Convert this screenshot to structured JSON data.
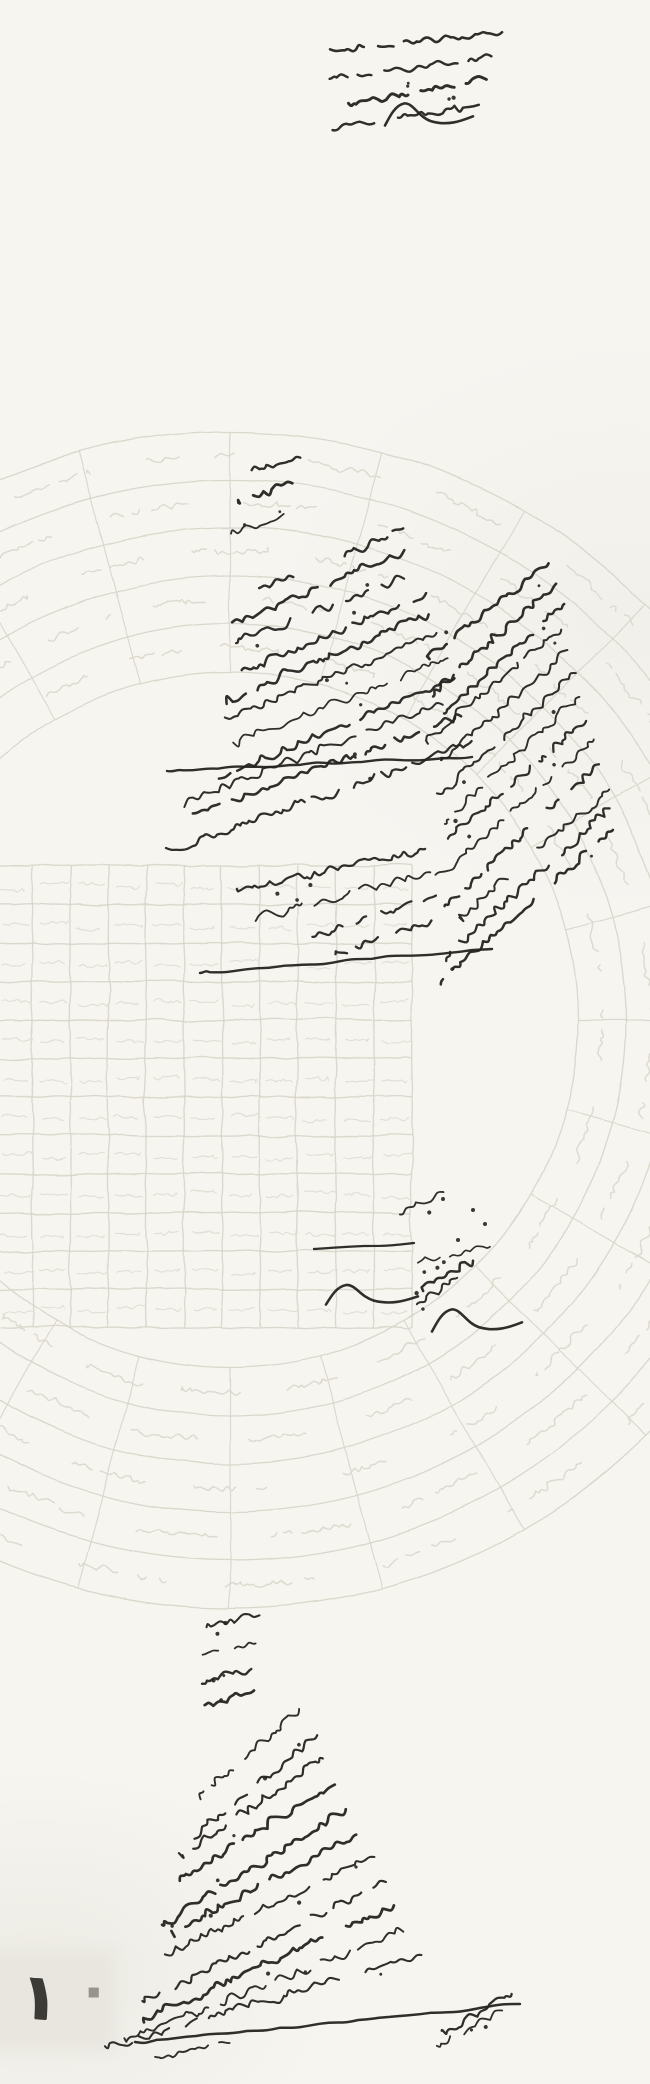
{
  "document": {
    "page_number": "١٠",
    "page_number_chars": [
      "١",
      "٠"
    ]
  },
  "palette": {
    "paper": "#f6f5f0",
    "faint_line": "#d8d4c8",
    "faint_text": "#ddd9cd",
    "grid_line": "#d7d3c7",
    "grid_text": "#e1ded3",
    "ink": "#242320",
    "shade": "#e8e6df",
    "digit_dark": "#3c3b36",
    "digit_light": "#96948d"
  },
  "artwork": {
    "canvas": {
      "width": 650,
      "height": 2084
    },
    "faint_circle": {
      "cx": 230,
      "cy": 1020,
      "ring_radii": [
        588,
        540,
        492,
        444,
        396,
        348
      ],
      "spoke_count": 24,
      "band_text_radii": [
        372,
        420,
        468,
        516,
        564
      ],
      "band_offsets": [
        3,
        9,
        0,
        6,
        11
      ]
    },
    "faint_grid": {
      "x": -6,
      "y": 866,
      "cols": 11,
      "rows": 12,
      "cell_w": 38,
      "cell_h": 38.5
    },
    "ink_blocks": [
      {
        "type": "para",
        "name": "top-right-annotation",
        "seed": 11,
        "rows": 4,
        "y0": 32,
        "rowH": 25,
        "right0": 502,
        "right1": 474,
        "len0": 170,
        "len1": 140,
        "slant0": 6,
        "slant1": 9,
        "amp": 5,
        "w": 2.2
      },
      {
        "type": "swoosh",
        "name": "top-right-flourish",
        "x": 385,
        "y": 100,
        "w": 88,
        "h": 34,
        "sw": 2.6
      },
      {
        "type": "para",
        "name": "middle-heading-column",
        "seed": 21,
        "rows": 3,
        "y0": 458,
        "rowH": 26,
        "right0": 301,
        "right1": 287,
        "len0": 52,
        "len1": 66,
        "slant0": 16,
        "slant1": 20,
        "amp": 5,
        "w": 2.1
      },
      {
        "type": "para",
        "name": "middle-main-paragraph",
        "seed": 22,
        "rows": 11,
        "y0": 530,
        "rowH": 21,
        "right0": 402,
        "right1": 470,
        "len0": 165,
        "len1": 300,
        "slant0": 24,
        "slant1": 20,
        "amp": 6,
        "w": 2.0
      },
      {
        "type": "line",
        "name": "middle-underline",
        "seed": 23,
        "xr": 472,
        "y": 757,
        "len": 305,
        "drop": 14,
        "amp": 2.5,
        "sw": 2.4
      },
      {
        "type": "para",
        "name": "right-diagonal-paragraph",
        "seed": 33,
        "rows": 13,
        "y0": 562,
        "rowH": 22.5,
        "right0": 548,
        "right1": 616,
        "len0": 150,
        "len1": 215,
        "slant0": 40,
        "slant1": 42,
        "amp": 5.5,
        "w": 2.0
      },
      {
        "type": "para",
        "name": "right-paragraph-left-extension",
        "seed": 34,
        "rows": 4,
        "y0": 847,
        "rowH": 24,
        "right0": 424,
        "right1": 436,
        "len0": 205,
        "len1": 95,
        "slant0": 13,
        "slant1": 22,
        "amp": 5.5,
        "w": 2.0
      },
      {
        "type": "line",
        "name": "right-paragraph-bottom-line",
        "seed": 35,
        "xr": 492,
        "y": 949,
        "len": 292,
        "drop": 24,
        "amp": 3,
        "sw": 2.4
      },
      {
        "type": "para",
        "name": "center-note-word",
        "seed": 41,
        "rows": 1,
        "y0": 1192,
        "rowH": 20,
        "right0": 440,
        "right1": 440,
        "len0": 48,
        "len1": 48,
        "slant0": 26,
        "slant1": 26,
        "amp": 5,
        "w": 2.0
      },
      {
        "type": "para",
        "name": "center-note-fragment",
        "seed": 42,
        "rows": 1,
        "y0": 1247,
        "rowH": 20,
        "right0": 489,
        "right1": 489,
        "len0": 70,
        "len1": 70,
        "slant0": 10,
        "slant1": 10,
        "amp": 4,
        "w": 1.9
      },
      {
        "type": "line",
        "name": "center-note-dash",
        "seed": 44,
        "xr": 414,
        "y": 1243,
        "len": 100,
        "drop": 6,
        "amp": 1.8,
        "sw": 2.2
      },
      {
        "type": "para",
        "name": "center-note-cluster",
        "seed": 43,
        "rows": 2,
        "y0": 1262,
        "rowH": 17,
        "right0": 468,
        "right1": 455,
        "len0": 58,
        "len1": 50,
        "slant0": 30,
        "slant1": 34,
        "amp": 5,
        "w": 2.0
      },
      {
        "type": "swoosh",
        "name": "center-flourish-1",
        "x": 326,
        "y": 1282,
        "w": 92,
        "h": 30,
        "sw": 2.6
      },
      {
        "type": "swoosh",
        "name": "center-flourish-2",
        "x": 432,
        "y": 1306,
        "w": 90,
        "h": 34,
        "sw": 2.6
      },
      {
        "type": "dots",
        "name": "center-note-dots",
        "r": 2,
        "pts": [
          [
            443,
            1199
          ],
          [
            473,
            1210
          ],
          [
            485,
            1224
          ],
          [
            458,
            1240
          ]
        ]
      },
      {
        "type": "para",
        "name": "bottom-heading-column",
        "seed": 51,
        "rows": 4,
        "y0": 1618,
        "rowH": 25,
        "right0": 263,
        "right1": 252,
        "len0": 55,
        "len1": 52,
        "slant0": 12,
        "slant1": 16,
        "amp": 5,
        "w": 2.1
      },
      {
        "type": "para",
        "name": "bottom-main-paragraph",
        "seed": 52,
        "rows": 11,
        "y0": 1712,
        "rowH": 24.5,
        "right0": 302,
        "right1": 420,
        "len0": 135,
        "len1": 305,
        "slant0": 40,
        "slant1": 18,
        "amp": 6,
        "w": 2.1
      },
      {
        "type": "para",
        "name": "bottom-right-cluster",
        "seed": 53,
        "rows": 2,
        "y0": 1992,
        "rowH": 20,
        "right0": 516,
        "right1": 505,
        "len0": 85,
        "len1": 70,
        "slant0": 28,
        "slant1": 30,
        "amp": 5,
        "w": 2.1
      },
      {
        "type": "line",
        "name": "bottom-final-line",
        "seed": 55,
        "xr": 520,
        "y": 2004,
        "len": 385,
        "drop": 38,
        "amp": 3,
        "sw": 2.5
      },
      {
        "type": "para",
        "name": "bottom-final-tail",
        "seed": 54,
        "rows": 1,
        "y0": 2042,
        "rowH": 20,
        "right0": 232,
        "right1": 232,
        "len0": 78,
        "len1": 78,
        "slant0": 12,
        "slant1": 12,
        "amp": 4.5,
        "w": 2.0
      }
    ]
  }
}
